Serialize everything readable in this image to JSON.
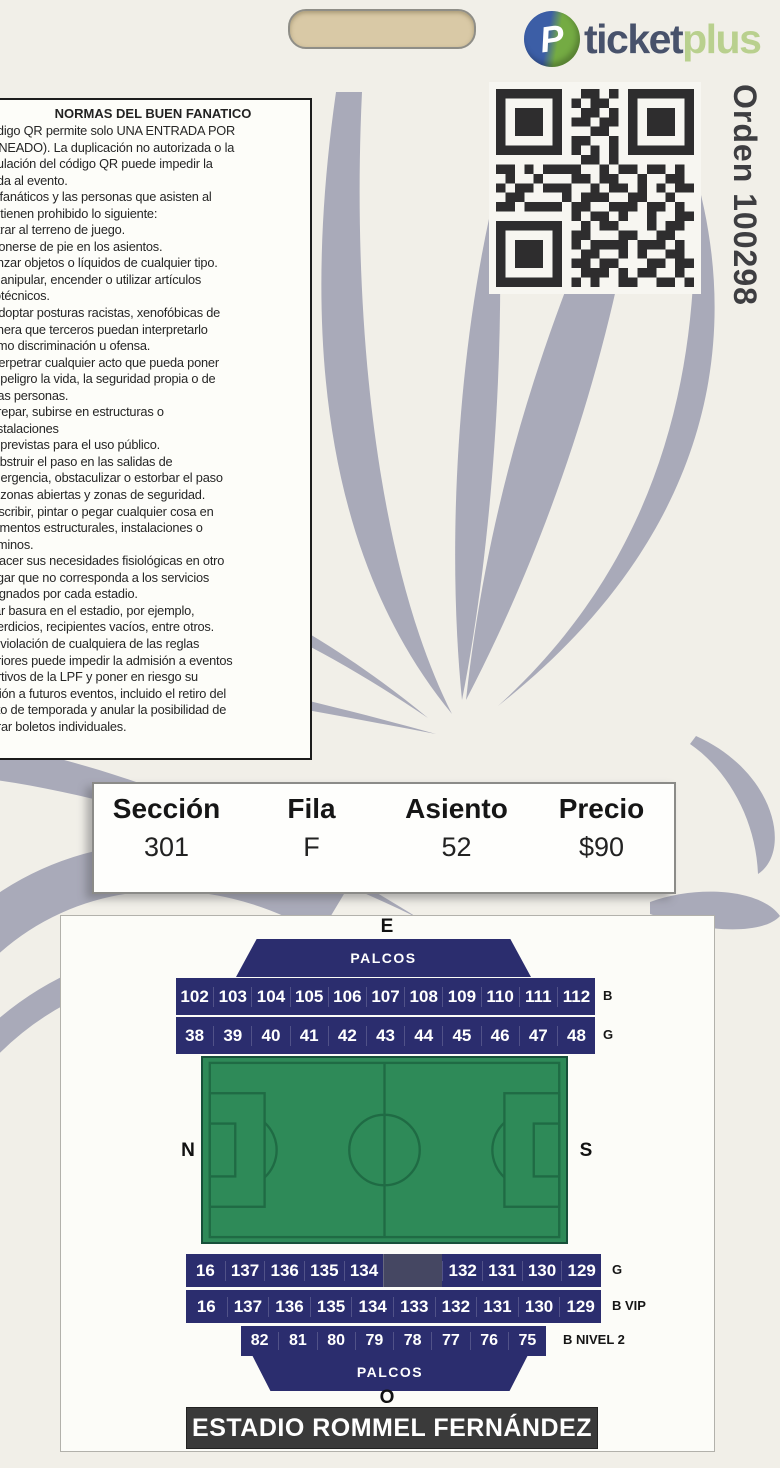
{
  "brand": {
    "logo_icon": "ticketplus-globe-icon",
    "logo_icon_letter": "P",
    "logo_text_primary": "ticket",
    "logo_text_secondary": "plus"
  },
  "order": {
    "label": "Orden 100298"
  },
  "qr": {
    "matrix": [
      "111111100110101111111",
      "100000101011001000001",
      "101110100110101011101",
      "101110101101101011101",
      "101110100011001011101",
      "100000101100101000001",
      "111111101010101111111",
      "000000000110100000000",
      "110101111001011011010",
      "010010001101100100110",
      "101101110010110101011",
      "011000010111001100100",
      "110111101100111011010",
      "000000001011010010011",
      "111111100101100010110",
      "100000101100011001100",
      "101110101011110111010",
      "101110100110010100110",
      "101110101101100011011",
      "100000100111010110010",
      "111111101010011001101"
    ]
  },
  "rules": {
    "title": "NORMAS DEL BUEN FANATICO",
    "lines": [
      "ódigo QR permite solo UNA ENTRADA POR",
      "ANEADO). La duplicación no autorizada o la",
      "pulación del código QR puede impedir la",
      "ada al evento.",
      "s fanáticos y las personas que asisten al",
      "o tienen prohibido lo siguiente:",
      "ntrar al terreno de juego.",
      "Ponerse de pie en los asientos.",
      "anzar objetos o líquidos de cualquier tipo.",
      "Manipular, encender o utilizar artículos",
      "rotécnicos.",
      "Adoptar posturas racistas, xenofóbicas de",
      "anera que terceros puedan interpretarlo",
      "omo discriminación u ofensa.",
      "Perpetrar cualquier acto que pueda poner",
      "n peligro la vida, la seguridad propia o de",
      "tras personas.",
      "Trepar, subirse en estructuras o",
      "nstalaciones",
      "o previstas para el uso público.",
      "Obstruir el paso en las salidas de",
      "mergencia, obstaculizar o estorbar el paso",
      "n zonas abiertas y zonas de seguridad.",
      "Escribir, pintar o pegar cualquier cosa en",
      "lementos estructurales, instalaciones o",
      "aminos.",
      "Hacer sus necesidades fisiológicas en otro",
      "ugar que no corresponda a los servicios",
      "signados por cada estadio.",
      "rar basura en el estadio, por ejemplo,",
      "perdicios, recipientes vacíos, entre otros.",
      "a violación de cualquiera de las reglas",
      "eriores puede impedir la admisión a eventos",
      "ortivos de la LPF y poner en riesgo su",
      "isión a futuros eventos, incluido el retiro del",
      "eto de temporada y anular la posibilidad de",
      "prar boletos individuales."
    ]
  },
  "seat_info": {
    "columns": [
      {
        "label": "Sección",
        "value": "301"
      },
      {
        "label": "Fila",
        "value": "F"
      },
      {
        "label": "Asiento",
        "value": "52"
      },
      {
        "label": "Precio",
        "value": "$90"
      }
    ]
  },
  "stadium_map": {
    "compass": {
      "east": "E",
      "west": "O",
      "north": "N",
      "south": "S"
    },
    "palcos_top": "PALCOS",
    "palcos_bottom": "PALCOS",
    "rows": [
      {
        "id": "upper-b",
        "label": "B",
        "cells": [
          "102",
          "103",
          "104",
          "105",
          "106",
          "107",
          "108",
          "109",
          "110",
          "111",
          "112"
        ]
      },
      {
        "id": "upper-g",
        "label": "G",
        "cells": [
          "38",
          "39",
          "40",
          "41",
          "42",
          "43",
          "44",
          "45",
          "46",
          "47",
          "48"
        ]
      },
      {
        "id": "lower-g",
        "label": "G",
        "cells": [
          "16",
          "137",
          "136",
          "135",
          "134",
          "",
          "132",
          "131",
          "130",
          "129"
        ]
      },
      {
        "id": "lower-b-vip",
        "label": "B VIP",
        "cells": [
          "16",
          "137",
          "136",
          "135",
          "134",
          "133",
          "132",
          "131",
          "130",
          "129"
        ]
      },
      {
        "id": "lower-b-nivel2",
        "label": "B NIVEL 2",
        "cells": [
          "82",
          "81",
          "80",
          "79",
          "78",
          "77",
          "76",
          "75"
        ]
      }
    ],
    "stadium_name": "ESTADIO ROMMEL FERNÁNDEZ"
  },
  "colors": {
    "navy": "#2b2d6e",
    "field_green": "#2e8a58",
    "field_line": "#1f6b44",
    "swirl_gray": "#a9aab9",
    "bar_dark": "#3a3a3a",
    "logo_navy": "#48526b",
    "logo_green": "#b9d08e",
    "qr_dark": "#2e2d2e",
    "punch_slot": "#d9c9a6"
  }
}
